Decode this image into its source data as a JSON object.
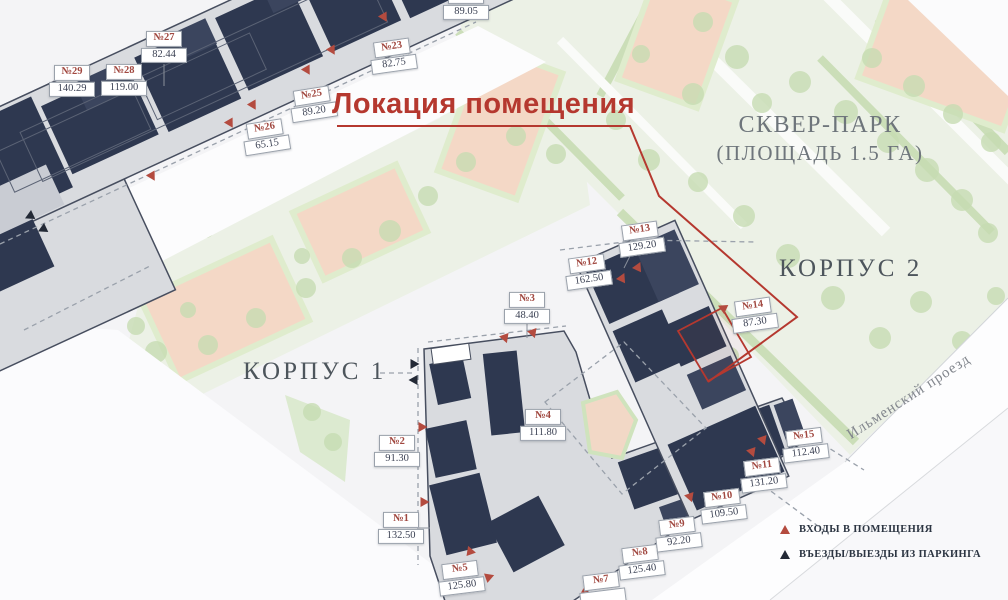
{
  "title": {
    "text": "Локация помещения"
  },
  "park": {
    "line1": "СКВЕР-ПАРК",
    "line2": "(ПЛОЩАДЬ 1.5 ГА)"
  },
  "buildings": {
    "korpus1": "КОРПУС 1",
    "korpus2": "КОРПУС 2"
  },
  "street": {
    "name": "Ильменский проезд"
  },
  "legend": {
    "items": [
      {
        "icon": "entrance-triangle-icon",
        "label": "ВХОДЫ В ПОМЕЩЕНИЯ"
      },
      {
        "icon": "parking-triangle-icon",
        "label": "ВЪЕЗДЫ/ВЫЕЗДЫ ИЗ ПАРКИНГА"
      }
    ]
  },
  "plots": [
    {
      "id": "№29",
      "area": "140.29",
      "x": 72,
      "y": 81,
      "rot": 0
    },
    {
      "id": "№28",
      "area": "119.00",
      "x": 124,
      "y": 80,
      "rot": 0
    },
    {
      "id": "№27",
      "area": "82.44",
      "x": 164,
      "y": 47,
      "rot": 0
    },
    {
      "id": "№26",
      "area": "65.15",
      "x": 266,
      "y": 137,
      "rot": -9
    },
    {
      "id": "№25",
      "area": "89.20",
      "x": 313,
      "y": 104,
      "rot": -9
    },
    {
      "id": "№23",
      "area": "82.75",
      "x": 393,
      "y": 56,
      "rot": -8
    },
    {
      "id": "№21",
      "area": "89.05",
      "x": 466,
      "y": 4,
      "rot": 0
    },
    {
      "id": "№13",
      "area": "129.20",
      "x": 641,
      "y": 239,
      "rot": -8
    },
    {
      "id": "№12",
      "area": "162.50",
      "x": 588,
      "y": 272,
      "rot": -8
    },
    {
      "id": "№3",
      "area": "48.40",
      "x": 527,
      "y": 308,
      "rot": 0
    },
    {
      "id": "№14",
      "area": "87.30",
      "x": 754,
      "y": 315,
      "rot": -8
    },
    {
      "id": "№2",
      "area": "91.30",
      "x": 397,
      "y": 451,
      "rot": 0
    },
    {
      "id": "№4",
      "area": "111.80",
      "x": 543,
      "y": 425,
      "rot": 0
    },
    {
      "id": "№1",
      "area": "132.50",
      "x": 401,
      "y": 528,
      "rot": 0
    },
    {
      "id": "№5",
      "area": "125.80",
      "x": 461,
      "y": 578,
      "rot": -7
    },
    {
      "id": "№7",
      "area": "",
      "x": 602,
      "y": 589,
      "rot": -7
    },
    {
      "id": "№8",
      "area": "125.40",
      "x": 641,
      "y": 562,
      "rot": -7
    },
    {
      "id": "№9",
      "area": "92.20",
      "x": 678,
      "y": 534,
      "rot": -7
    },
    {
      "id": "№10",
      "area": "109.50",
      "x": 723,
      "y": 506,
      "rot": -7
    },
    {
      "id": "№11",
      "area": "131.20",
      "x": 763,
      "y": 475,
      "rot": -7
    },
    {
      "id": "№15",
      "area": "112.40",
      "x": 805,
      "y": 445,
      "rot": -7
    }
  ],
  "colors": {
    "accent_red": "#b5382f",
    "marker_red": "#b44b3f",
    "marker_black": "#232936",
    "building_dark": "#2e3850",
    "court_pink": "#f4d8c6",
    "label_red": "#a14840",
    "label_navy": "#3c4254"
  }
}
